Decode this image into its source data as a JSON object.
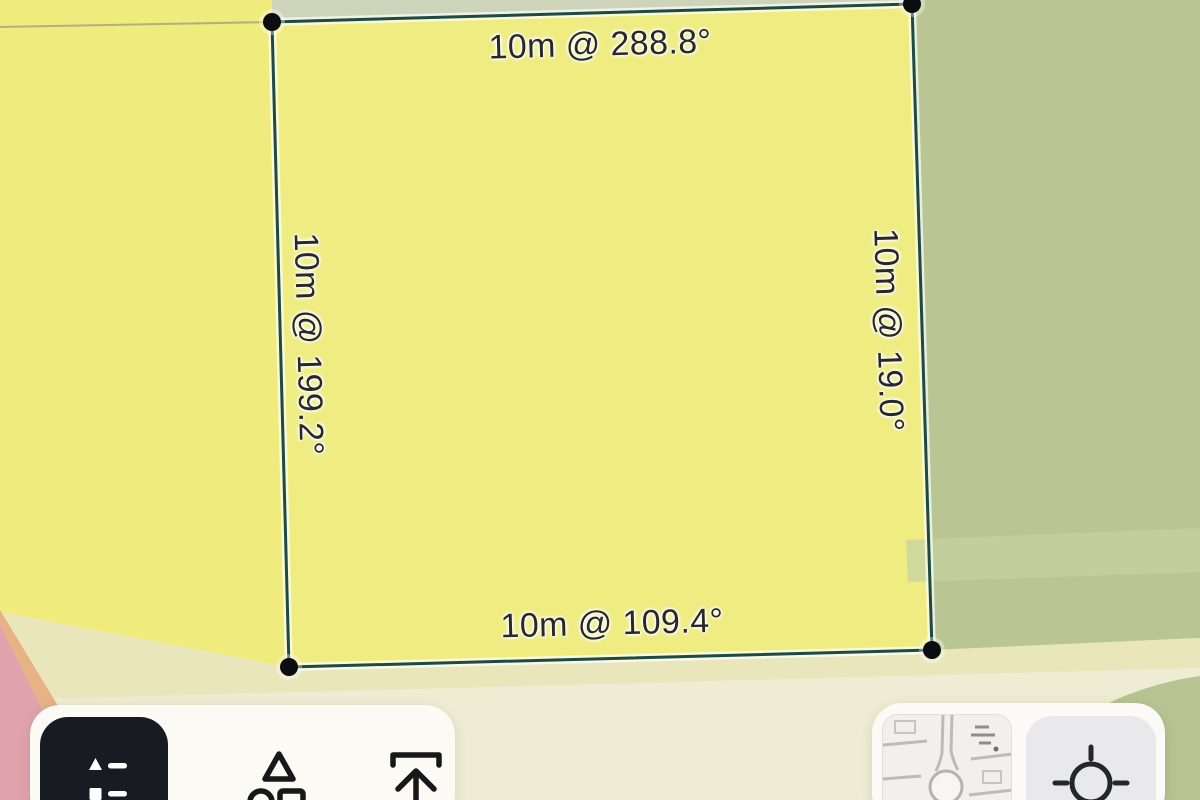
{
  "measurement": {
    "side_length": "10m",
    "top_label": "10m @ 288.8°",
    "right_label": "10m @ 19.0°",
    "bottom_label": "10m @ 109.4°",
    "left_label": "10m @ 199.2°",
    "bearings": {
      "top": "288.8°",
      "right": "19.0°",
      "bottom": "109.4°",
      "left": "199.2°"
    }
  },
  "toolbar": {
    "buttons": [
      {
        "name": "legend",
        "icon": "legend-list-icon",
        "active": true
      },
      {
        "name": "shapes",
        "icon": "shapes-icon",
        "active": false
      },
      {
        "name": "export",
        "icon": "export-up-icon",
        "active": false
      }
    ]
  },
  "map_widgets": {
    "basemap_switcher": {
      "icon": "basemap-thumbnail"
    },
    "locate": {
      "icon": "locate-crosshair-icon"
    }
  },
  "colors": {
    "parcel_yellow": "#efec7d",
    "parcel_green": "#b9c694",
    "parcel_pink": "#e0a3ac",
    "parcel_orange": "#e6b286",
    "band_cream": "#e9e6bb",
    "band_light": "#eeecd2",
    "wedge_green": "#ced4ba",
    "measure_line": "#1d4a41",
    "vertex_dot": "#0c0d10",
    "label_text": "#28282c",
    "toolbar_bg": "#fcfaf5",
    "dark_button_bg": "#181b22"
  }
}
